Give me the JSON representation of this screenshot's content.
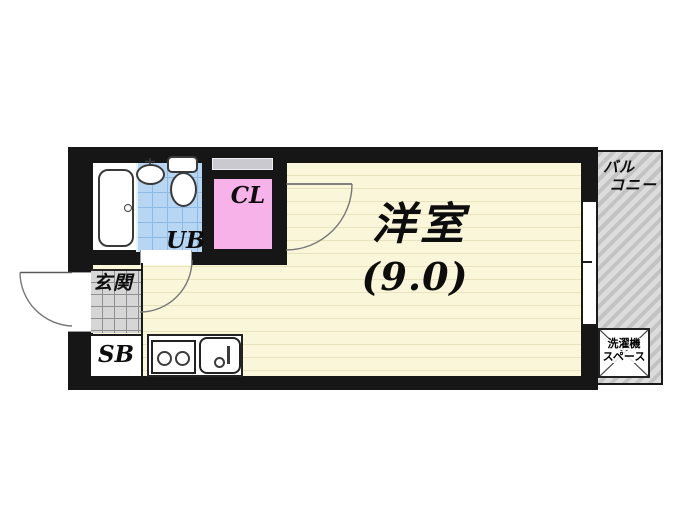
{
  "floorplan": {
    "rooms": {
      "main": {
        "name": "洋室",
        "area": "(9.0)"
      },
      "closet": {
        "abbr": "CL"
      },
      "bath": {
        "abbr": "UB"
      },
      "entrance": {
        "name": "玄関"
      },
      "shoebox": {
        "abbr": "SB"
      },
      "balcony": {
        "line1": "バル",
        "line2": "コニー"
      },
      "laundry": {
        "line1": "洗濯機",
        "line2": "スペース"
      }
    },
    "colors": {
      "wall": "#161616",
      "flooring": "#f9f6da",
      "flooring_line": "#e8e3bd",
      "bath_tile": "#b7d6f3",
      "bath_tile_line": "#8cb9e6",
      "closet_pink": "#f6b2e9",
      "entrance_tile": "#d6d6d6",
      "entrance_tile_line": "#8f8f8f",
      "balcony_stripe_dark": "#c3c3c3",
      "balcony_stripe_light": "#dcdcdc",
      "fixture_outline": "#3a3a3a"
    }
  }
}
